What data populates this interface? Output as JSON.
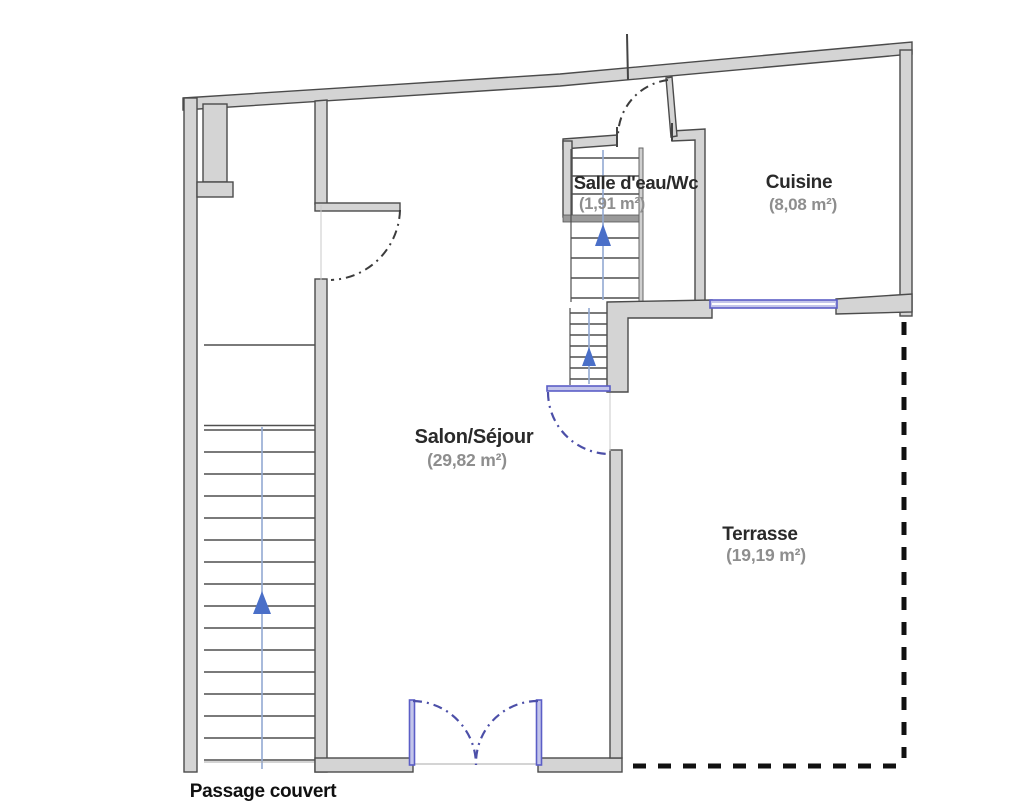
{
  "plan_title": "floor-plan",
  "rooms": [
    {
      "name": "Salle d'eau/Wc",
      "area": "(1,91 m²)"
    },
    {
      "name": "Cuisine",
      "area": "(8,08 m²)"
    },
    {
      "name": "Salon/Séjour",
      "area": "(29,82 m²)"
    },
    {
      "name": "Terrasse",
      "area": "(19,19 m²)"
    }
  ],
  "annotations": {
    "passage": "Passage couvert"
  },
  "colors": {
    "background": "#ffffff",
    "wall_fill": "#d4d4d4",
    "wall_stroke": "#4b4b4b",
    "step_line": "#4f4f4f",
    "stair_blue": "#4a6fc8",
    "centerline_blue": "#93a9d2",
    "glazing_fill": "#c3c5ea",
    "glazing_stroke": "#5b5ec6",
    "door_arc_blue": "#4c4fa8",
    "door_arc_dark": "#3c3c3c",
    "boundary_dash": "#111111",
    "room_name_text": "#2a2a2a",
    "room_area_text": "#8e8e8e"
  }
}
